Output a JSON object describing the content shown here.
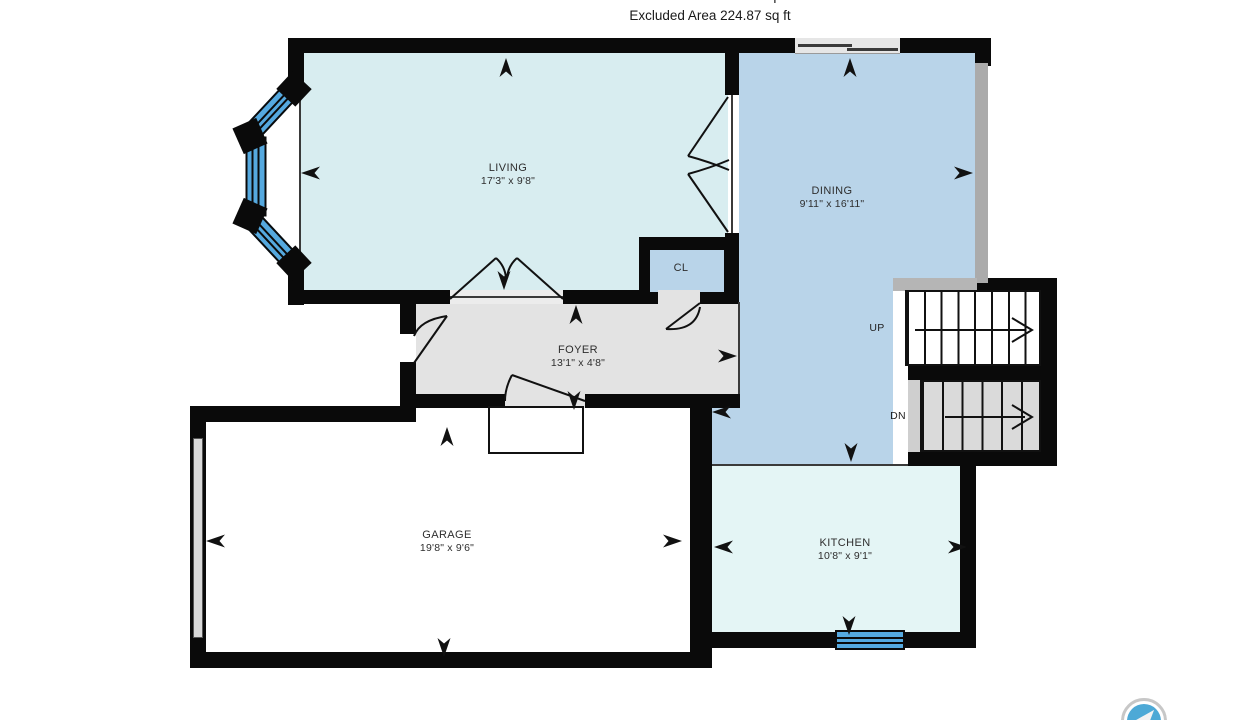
{
  "header": {
    "interior_area": "Interior Area 1091.74 sq ft",
    "excluded_area": "Excluded Area 224.87 sq ft"
  },
  "rooms": {
    "living": {
      "name": "LIVING",
      "dims": "17'3\" x 9'8\""
    },
    "dining": {
      "name": "DINING",
      "dims": "9'11\" x 16'11\""
    },
    "foyer": {
      "name": "FOYER",
      "dims": "13'1\" x 4'8\""
    },
    "garage": {
      "name": "GARAGE",
      "dims": "19'8\" x 9'6\""
    },
    "kitchen": {
      "name": "KITCHEN",
      "dims": "10'8\" x 9'1\""
    },
    "closet": {
      "name": "CL"
    }
  },
  "stairs": {
    "up_label": "UP",
    "dn_label": "DN"
  },
  "colors": {
    "wall": "#0a0a0a",
    "window_blue": "#55a9df",
    "living_fill": "#d8edf0",
    "dining_fill": "#b9d4e9",
    "kitchen_fill": "#e4f5f5",
    "foyer_fill": "#e3e3e3",
    "garage_fill": "#ffffff"
  }
}
